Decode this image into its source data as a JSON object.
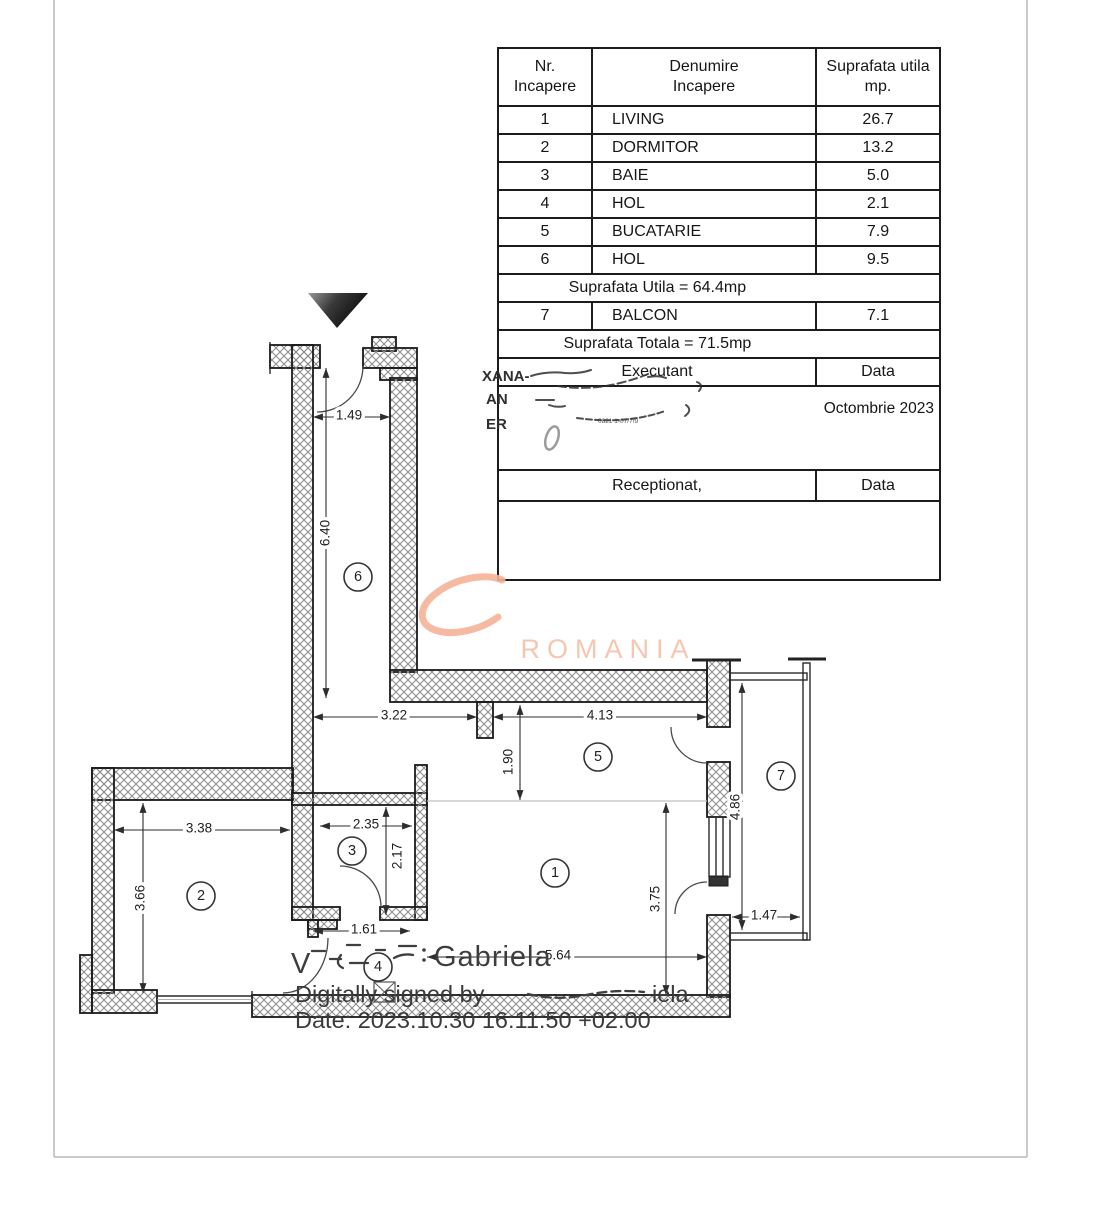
{
  "table": {
    "header": {
      "col1_line1": "Nr.",
      "col1_line2": "Incapere",
      "col2_line1": "Denumire",
      "col2_line2": "Incapere",
      "col3_line1": "Suprafata utila",
      "col3_line2": "mp."
    },
    "rows": [
      {
        "nr": "1",
        "name": "LIVING",
        "area": "26.7"
      },
      {
        "nr": "2",
        "name": "DORMITOR",
        "area": "13.2"
      },
      {
        "nr": "3",
        "name": "BAIE",
        "area": "5.0"
      },
      {
        "nr": "4",
        "name": "HOL",
        "area": "2.1"
      },
      {
        "nr": "5",
        "name": "BUCATARIE",
        "area": "7.9"
      },
      {
        "nr": "6",
        "name": "HOL",
        "area": "9.5"
      }
    ],
    "subtotal": "Suprafata Utila = 64.4mp",
    "balcony_row": {
      "nr": "7",
      "name": "BALCON",
      "area": "7.1"
    },
    "total": "Suprafata Totala = 71.5mp",
    "executant_label": "Executant",
    "executant_data_label": "Data",
    "executant_date": "Octombrie 2023",
    "stamp_fragments": {
      "f1": "XANA-",
      "f2": "AN",
      "f3": "ER",
      "micro": "0821 1-07/7/9"
    },
    "receptionat_label": "Receptionat,",
    "receptionat_data_label": "Data"
  },
  "plan": {
    "dims": {
      "entrance_width": "1.49",
      "hall_length": "6.40",
      "hall_width": "3.22",
      "kitchen_width": "4.13",
      "kitchen_depth": "1.90",
      "bedroom_width": "3.38",
      "bedroom_depth": "3.66",
      "bath_width": "2.35",
      "bath_depth": "2.17",
      "hol_width": "1.61",
      "living_width": "5.64",
      "living_depth": "3.75",
      "balcony_length": "4.86",
      "balcony_width": "1.47"
    },
    "rooms": {
      "living": "1",
      "dormitor": "2",
      "baie": "3",
      "hol4": "4",
      "bucatarie": "5",
      "hol6": "6",
      "balcon": "7"
    }
  },
  "watermark": {
    "text": "ROMANIA"
  },
  "signature": {
    "visible_initial": "V",
    "visible_name": "Gabriela",
    "line2_prefix": "Digitally signed by",
    "line2_suffix": "iela",
    "line3": "Date: 2023.10.30 16:11:50 +02:00"
  }
}
